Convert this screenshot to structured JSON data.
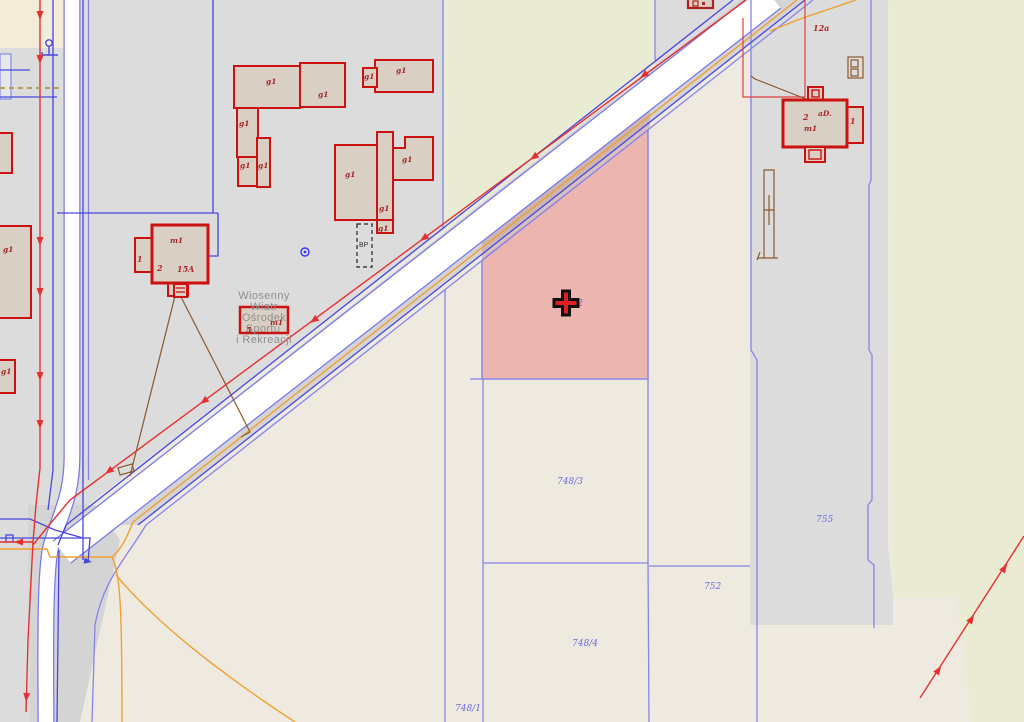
{
  "map": {
    "selected_parcel": {
      "label": "748/2",
      "fill": "#eb8282",
      "label_color": "#8a50c8"
    },
    "parcel_labels": {
      "p748_2": "748/2",
      "p748_3": "748/3",
      "p748_4": "748/4",
      "p748_1": "748/1",
      "p752": "752",
      "p755": "755"
    },
    "poi": {
      "line1": "Wiosenny",
      "line2": "Wiatr",
      "line3": "Ośrodek",
      "line4": "Sportu",
      "line5": "i Rekreacji"
    },
    "building_labels": {
      "g1": "g1",
      "m1": "m1",
      "bp": "BP",
      "num1": "1",
      "num2": "2",
      "num5": "5",
      "num15a": "15A",
      "num12a": "12a",
      "ad": "aD."
    },
    "colors": {
      "base_parcel": "#eeeae0",
      "gray_area": "#dcdcdc",
      "yellow_green_area": "#e9ecd2",
      "cream_area": "#f2ecd8",
      "road_fill": "#ffffff",
      "road_shoulder": "#d4d4d4",
      "building_fill": "#d9cfc4",
      "building_stroke": "#cc1111",
      "parcel_line": "#8585e8",
      "parcel_label": "#6b6be0",
      "building_label": "#a02828",
      "utility_red": "#e83030",
      "utility_orange": "#f0a030",
      "utility_blue": "#4747e0",
      "fence_brown": "#8a5a30",
      "poi_text": "#8f8f8f",
      "marker_fill": "#e02020",
      "marker_stroke": "#111111"
    }
  }
}
